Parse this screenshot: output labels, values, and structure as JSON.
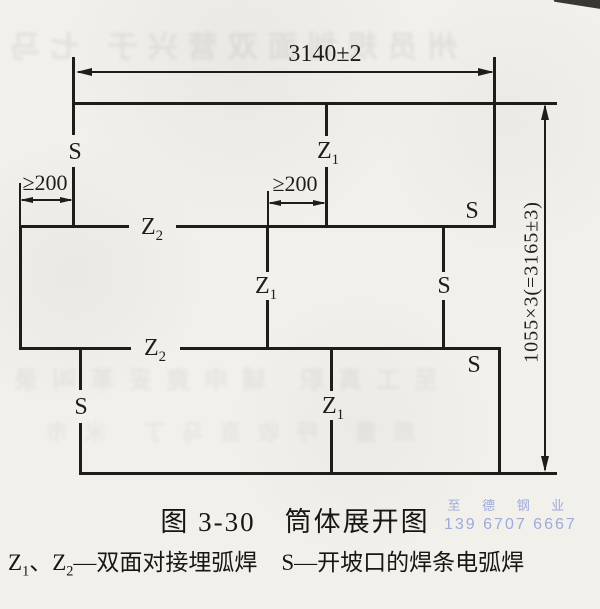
{
  "colors": {
    "ink": "#1f1d1a",
    "paper": "#f2f0ea",
    "watermark": "#9fa9dc"
  },
  "drawing": {
    "dim_width": "3140±2",
    "dim_height": "1055×3(=3165±3)",
    "dim_stagger_left": "≥200",
    "dim_stagger_middle": "≥200",
    "labels": {
      "s": "S",
      "z": "Z",
      "sub1": "1",
      "sub2": "2"
    }
  },
  "caption": "图 3-30　筒体展开图",
  "legend": {
    "z1_base": "Z",
    "z1_sub": "1",
    "separator": "、",
    "z2_base": "Z",
    "z2_sub": "2",
    "z_desc": "—双面对接埋弧焊",
    "s_base": "S",
    "s_desc": "—开坡口的焊条电弧焊"
  },
  "watermark": {
    "company": "至 德 钢 业",
    "phone": "139 6707 6667"
  },
  "scan_noise": {
    "bleed_top": "州员规划面双营兴于 七马",
    "bleed_mid": "至工真职 辅申竟妥革叫录",
    "bleed_low": "质量 呼收直马丁 米市"
  }
}
